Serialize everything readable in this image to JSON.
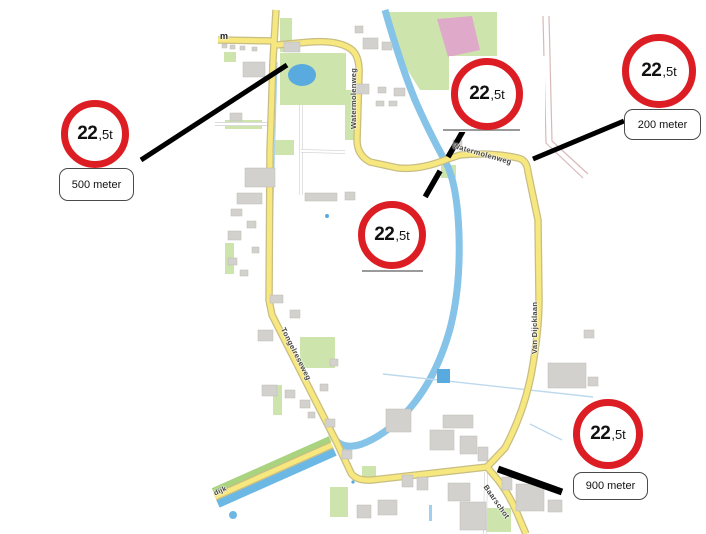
{
  "signs": [
    {
      "big": "22",
      "small": ",5t"
    },
    {
      "big": "22",
      "small": ",5t"
    },
    {
      "big": "22",
      "small": ",5t"
    },
    {
      "big": "22",
      "small": ",5t"
    },
    {
      "big": "22",
      "small": ",5t"
    }
  ],
  "distance_notes": {
    "left": "500 meter",
    "right": "200 meter",
    "bottom": "900 meter"
  },
  "road_labels": {
    "watermolenweg_vertical": "Watermolenweg",
    "watermolenweg_horizontal": "Watermolenweg",
    "van_dijcklaan": "Van Dijcklaan",
    "tongelreseweg": "Tongelreseweg",
    "baarschot": "Baarschot",
    "m_partial": "m",
    "dijk_partial": "dijk"
  },
  "colors": {
    "sign_red": "#dd1d24",
    "road_yellow": "#f7e77f",
    "water_blue": "#85c3e8",
    "grass_green": "#cde5ad",
    "pink_area": "#dfa9c9",
    "building_gray": "#d3d1cd",
    "leader_black": "#000000"
  }
}
